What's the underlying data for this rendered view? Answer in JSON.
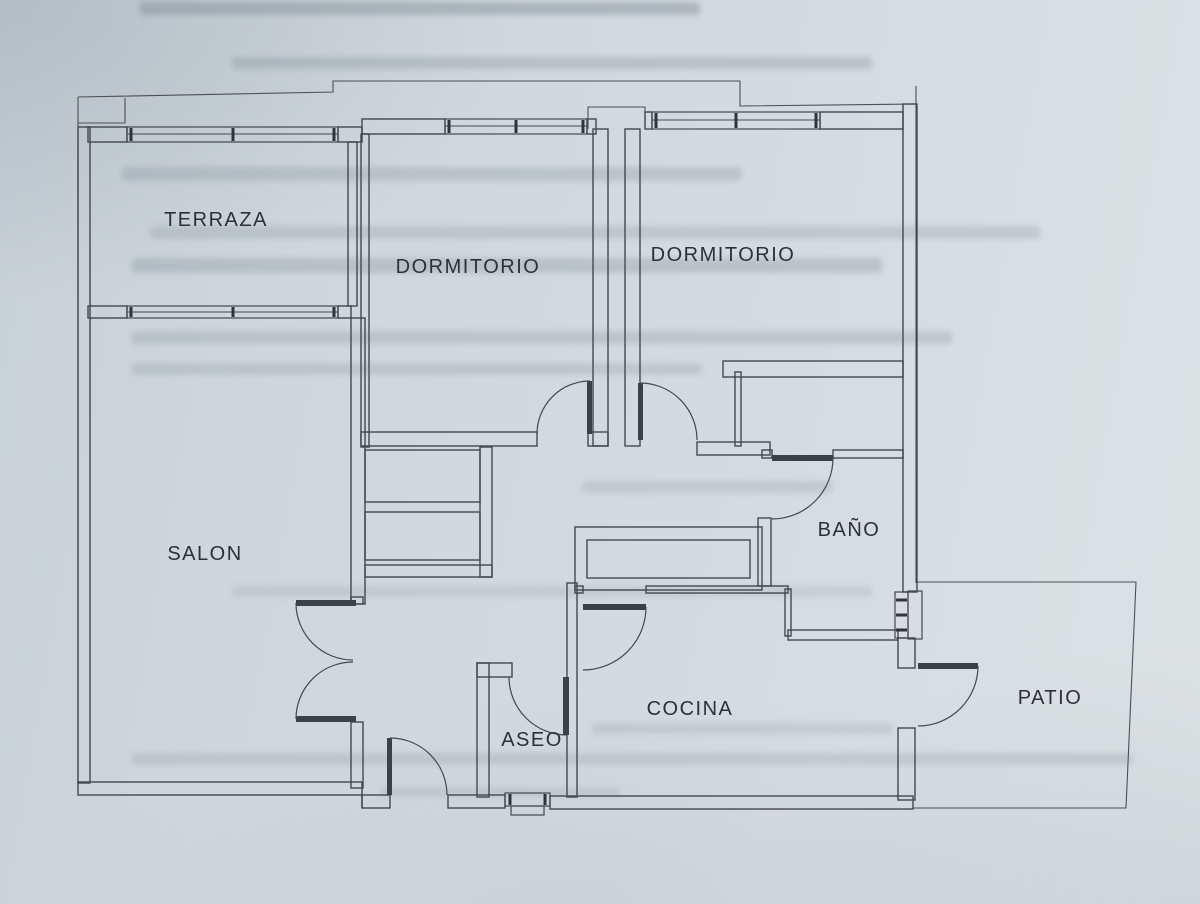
{
  "floor_plan": {
    "description": "Scanned apartment floor plan on bluish paper with faint text bleed-through",
    "rooms": {
      "terraza": {
        "label": "TERRAZA"
      },
      "dormitorio_1": {
        "label": "DORMITORIO"
      },
      "dormitorio_2": {
        "label": "DORMITORIO"
      },
      "salon": {
        "label": "SALON"
      },
      "bano": {
        "label": "BAÑO"
      },
      "cocina": {
        "label": "COCINA"
      },
      "aseo": {
        "label": "ASEO"
      },
      "patio": {
        "label": "PATIO"
      }
    },
    "features": {
      "windows": [
        "terraza-top",
        "terraza-salon",
        "dormitorio-1-top",
        "dormitorio-2-top",
        "bano-side",
        "aseo-bottom"
      ],
      "doors": [
        "salon-double-door",
        "entrance-door",
        "dormitorio-1-door",
        "dormitorio-2-door",
        "bano-door",
        "cocina-door",
        "aseo-door",
        "patio-door"
      ]
    },
    "colors": {
      "paper": "#d2dade",
      "line": "#43484d",
      "text": "#2c3136"
    }
  }
}
